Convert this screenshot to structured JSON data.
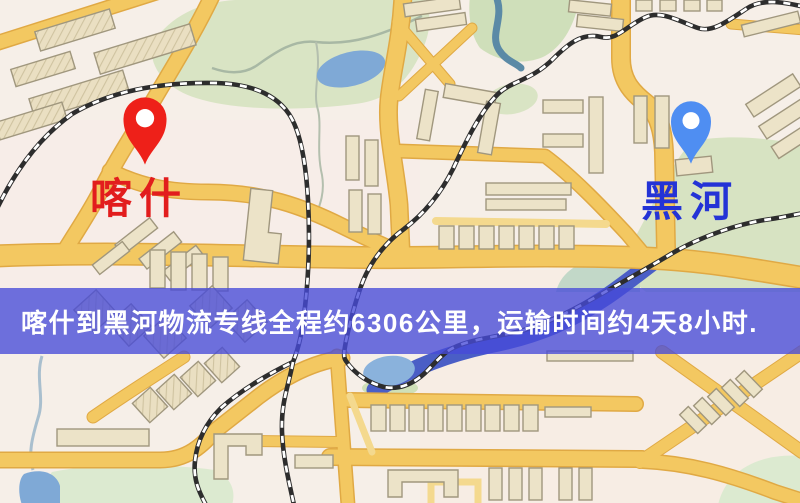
{
  "map": {
    "type": "static-route-map",
    "markers": [
      {
        "id": "origin",
        "label": "喀什",
        "pin_color": "#ee2019",
        "label_color": "#e21d1d"
      },
      {
        "id": "destination",
        "label": "黑河",
        "pin_color": "#4f8ef2",
        "label_color": "#2433d6"
      }
    ],
    "banner": {
      "text": "喀什到黑河物流专线全程约6306公里，运输时间约4天8小时.",
      "background": "#464ad8",
      "text_color": "#ffffff"
    },
    "route": {
      "from": "喀什",
      "to": "黑河",
      "distance": "约6306公里",
      "duration": "约4天8小时"
    },
    "colors": {
      "background": "#f6efe8",
      "road_fill": "#f3c861",
      "road_casing": "#e0a944",
      "railway": "#2d2d2d",
      "water": "#7fa9d6",
      "river": "#4a5ec6",
      "green_area": "#d9e4c4",
      "building": "#ece3c8"
    }
  }
}
